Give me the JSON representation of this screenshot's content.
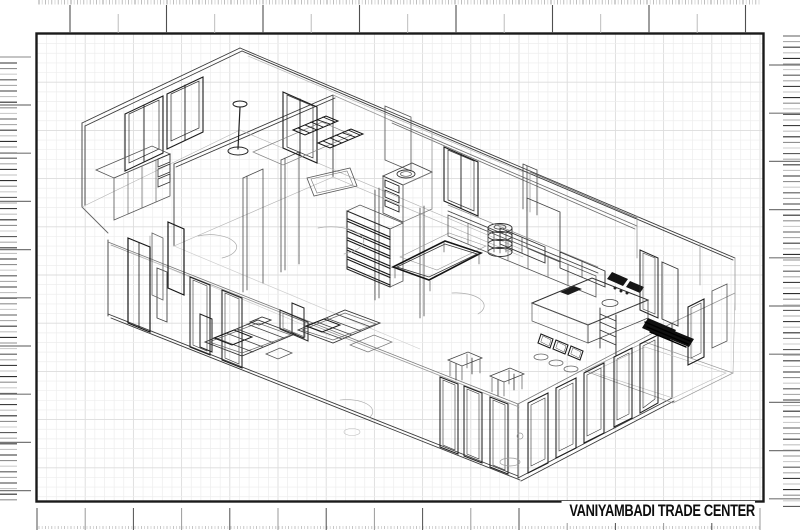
{
  "title_block": {
    "title": "VANIYAMBADI TRADE CENTER"
  },
  "sheet": {
    "background_color": "#ffffff",
    "frame_color": "#1a1a1a",
    "grid_minor_color": "#ededed",
    "grid_major_color": "#dcdcdc",
    "ink_color": "#1c1c1c"
  }
}
